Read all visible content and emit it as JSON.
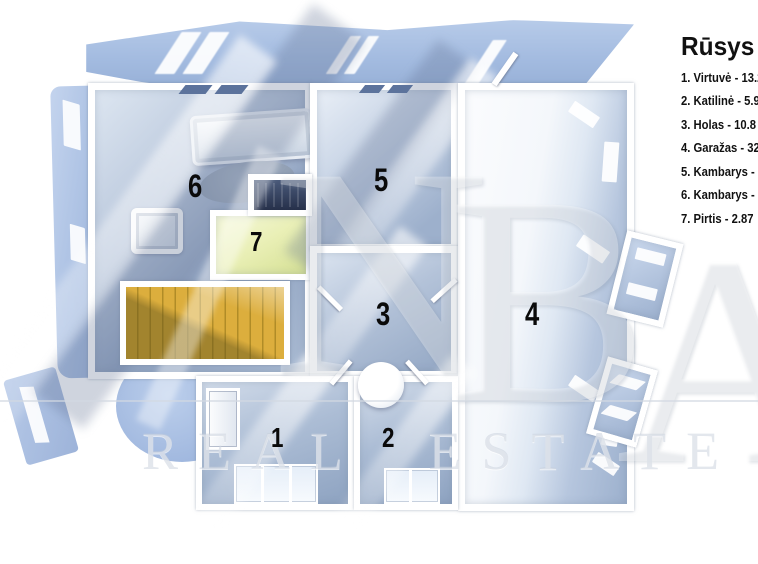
{
  "legend": {
    "title": "Rūsys",
    "items": [
      "1. Virtuvė - 13.2",
      "2. Katilinė - 5.9",
      "3. Holas - 10.8",
      "4. Garažas - 32",
      "5. Kambarys -",
      "6. Kambarys -",
      "7. Pirtis - 2.87"
    ]
  },
  "plan": {
    "floor_name": "Rūsys",
    "room_numbers": [
      "1",
      "2",
      "3",
      "4",
      "5",
      "6",
      "7"
    ]
  },
  "watermark": {
    "brand_letters": [
      "N",
      "B",
      "A"
    ],
    "text": "REAL ESTATE"
  },
  "colors": {
    "wall_white": "#ffffff",
    "floor_blue": "#9db1cf",
    "roof_blue": "#a9c2e6",
    "stairs_gold": "#d2a335",
    "sauna_floor": "#e9efb5",
    "dark_bench": "#2f3a52",
    "legend_text": "#111111"
  }
}
